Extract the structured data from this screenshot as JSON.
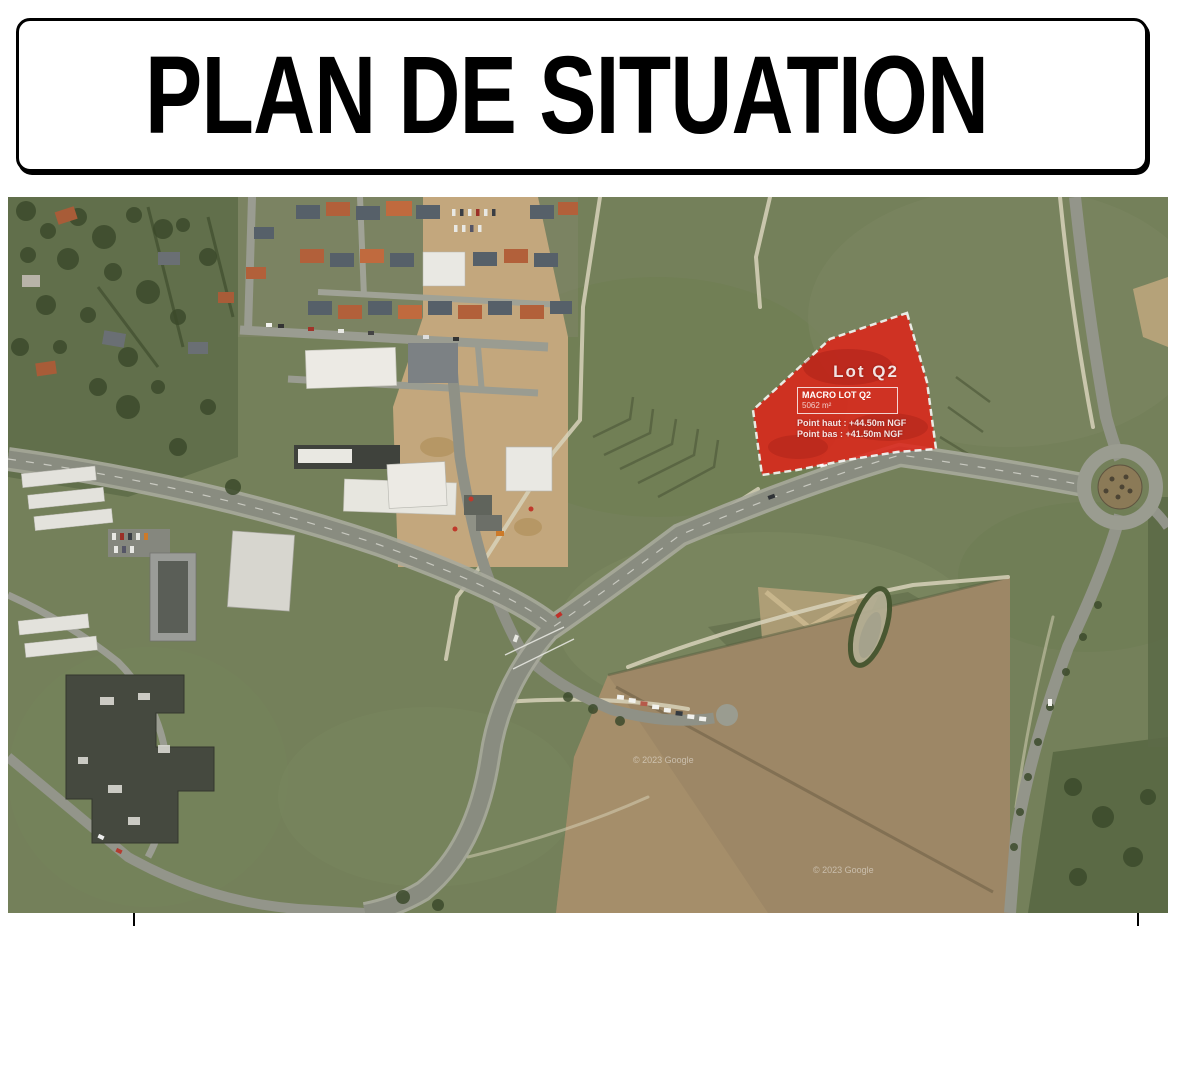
{
  "title": {
    "text": "PLAN DE SITUATION"
  },
  "map": {
    "watermark": "© 2023 Google",
    "lot": {
      "name": "Lot Q2",
      "macro_label": "MACRO LOT Q2",
      "area": "5062 m²",
      "point_haut": "Point haut : +44.50m NGF",
      "point_bas": "Point bas : +41.50m NGF",
      "fill_color": "#e02318",
      "border_color": "#ffffff"
    }
  }
}
